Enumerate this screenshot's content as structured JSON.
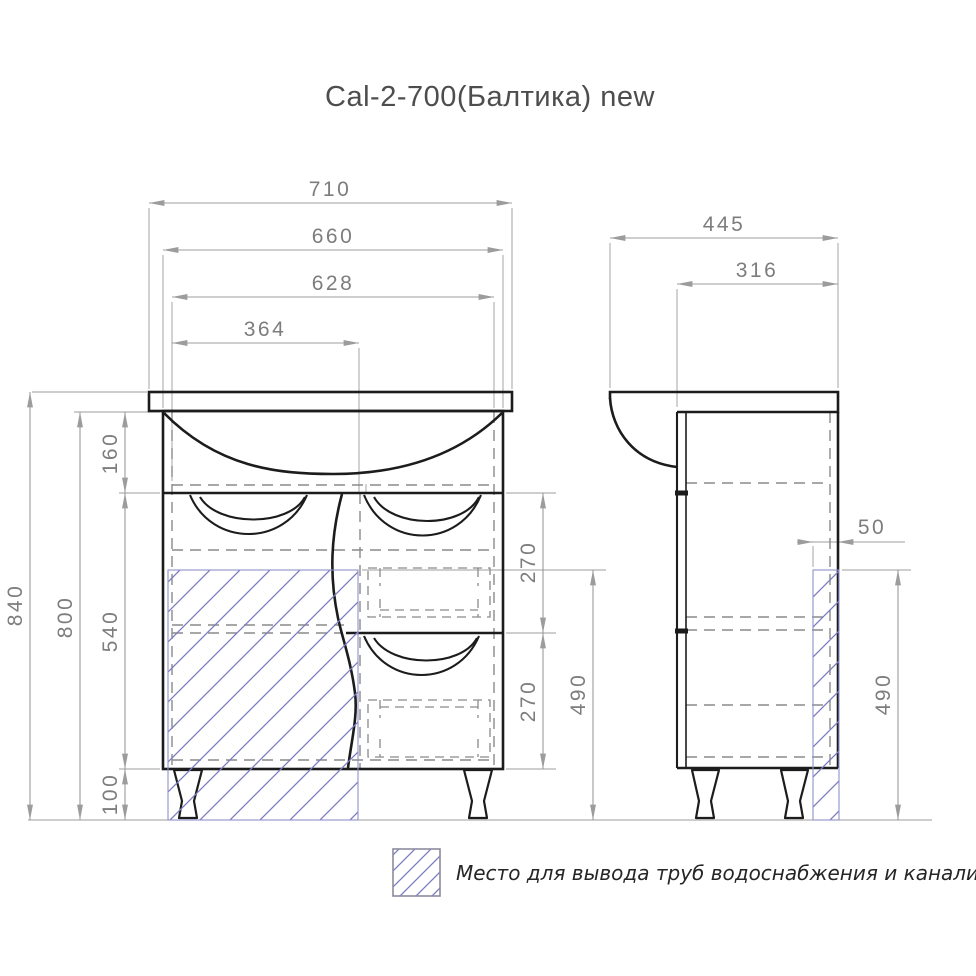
{
  "title": "Cal-2-700(Балтика) new",
  "dims": {
    "front_overall_width": "710",
    "front_cabinet_width": "660",
    "front_inner_width": "628",
    "front_left_section_width": "364",
    "front_overall_height": "840",
    "front_cabinet_height": "800",
    "front_top_section_height": "160",
    "front_door_height": "540",
    "front_leg_height": "100",
    "front_drawer_top_height": "270",
    "front_drawer_bottom_height": "270",
    "front_pipe_zone_height": "490",
    "side_overall_depth": "445",
    "side_body_depth": "316",
    "side_pipe_zone_depth": "50",
    "side_pipe_zone_height": "490"
  },
  "legend": {
    "label": "Место для вывода труб водоснабжения и канализации",
    "icon": "hatch-swatch-icon"
  },
  "colors": {
    "line": "#1c1c1c",
    "hidden_line": "#8a8a8a",
    "dimension_line": "#9c9c9c",
    "dimension_text": "#7d7d7d",
    "hatch_line": "#7b7bc2",
    "hatch_border": "#9090cc",
    "title_text": "#4d4d4d",
    "legend_text": "#262626",
    "background": "#ffffff"
  }
}
